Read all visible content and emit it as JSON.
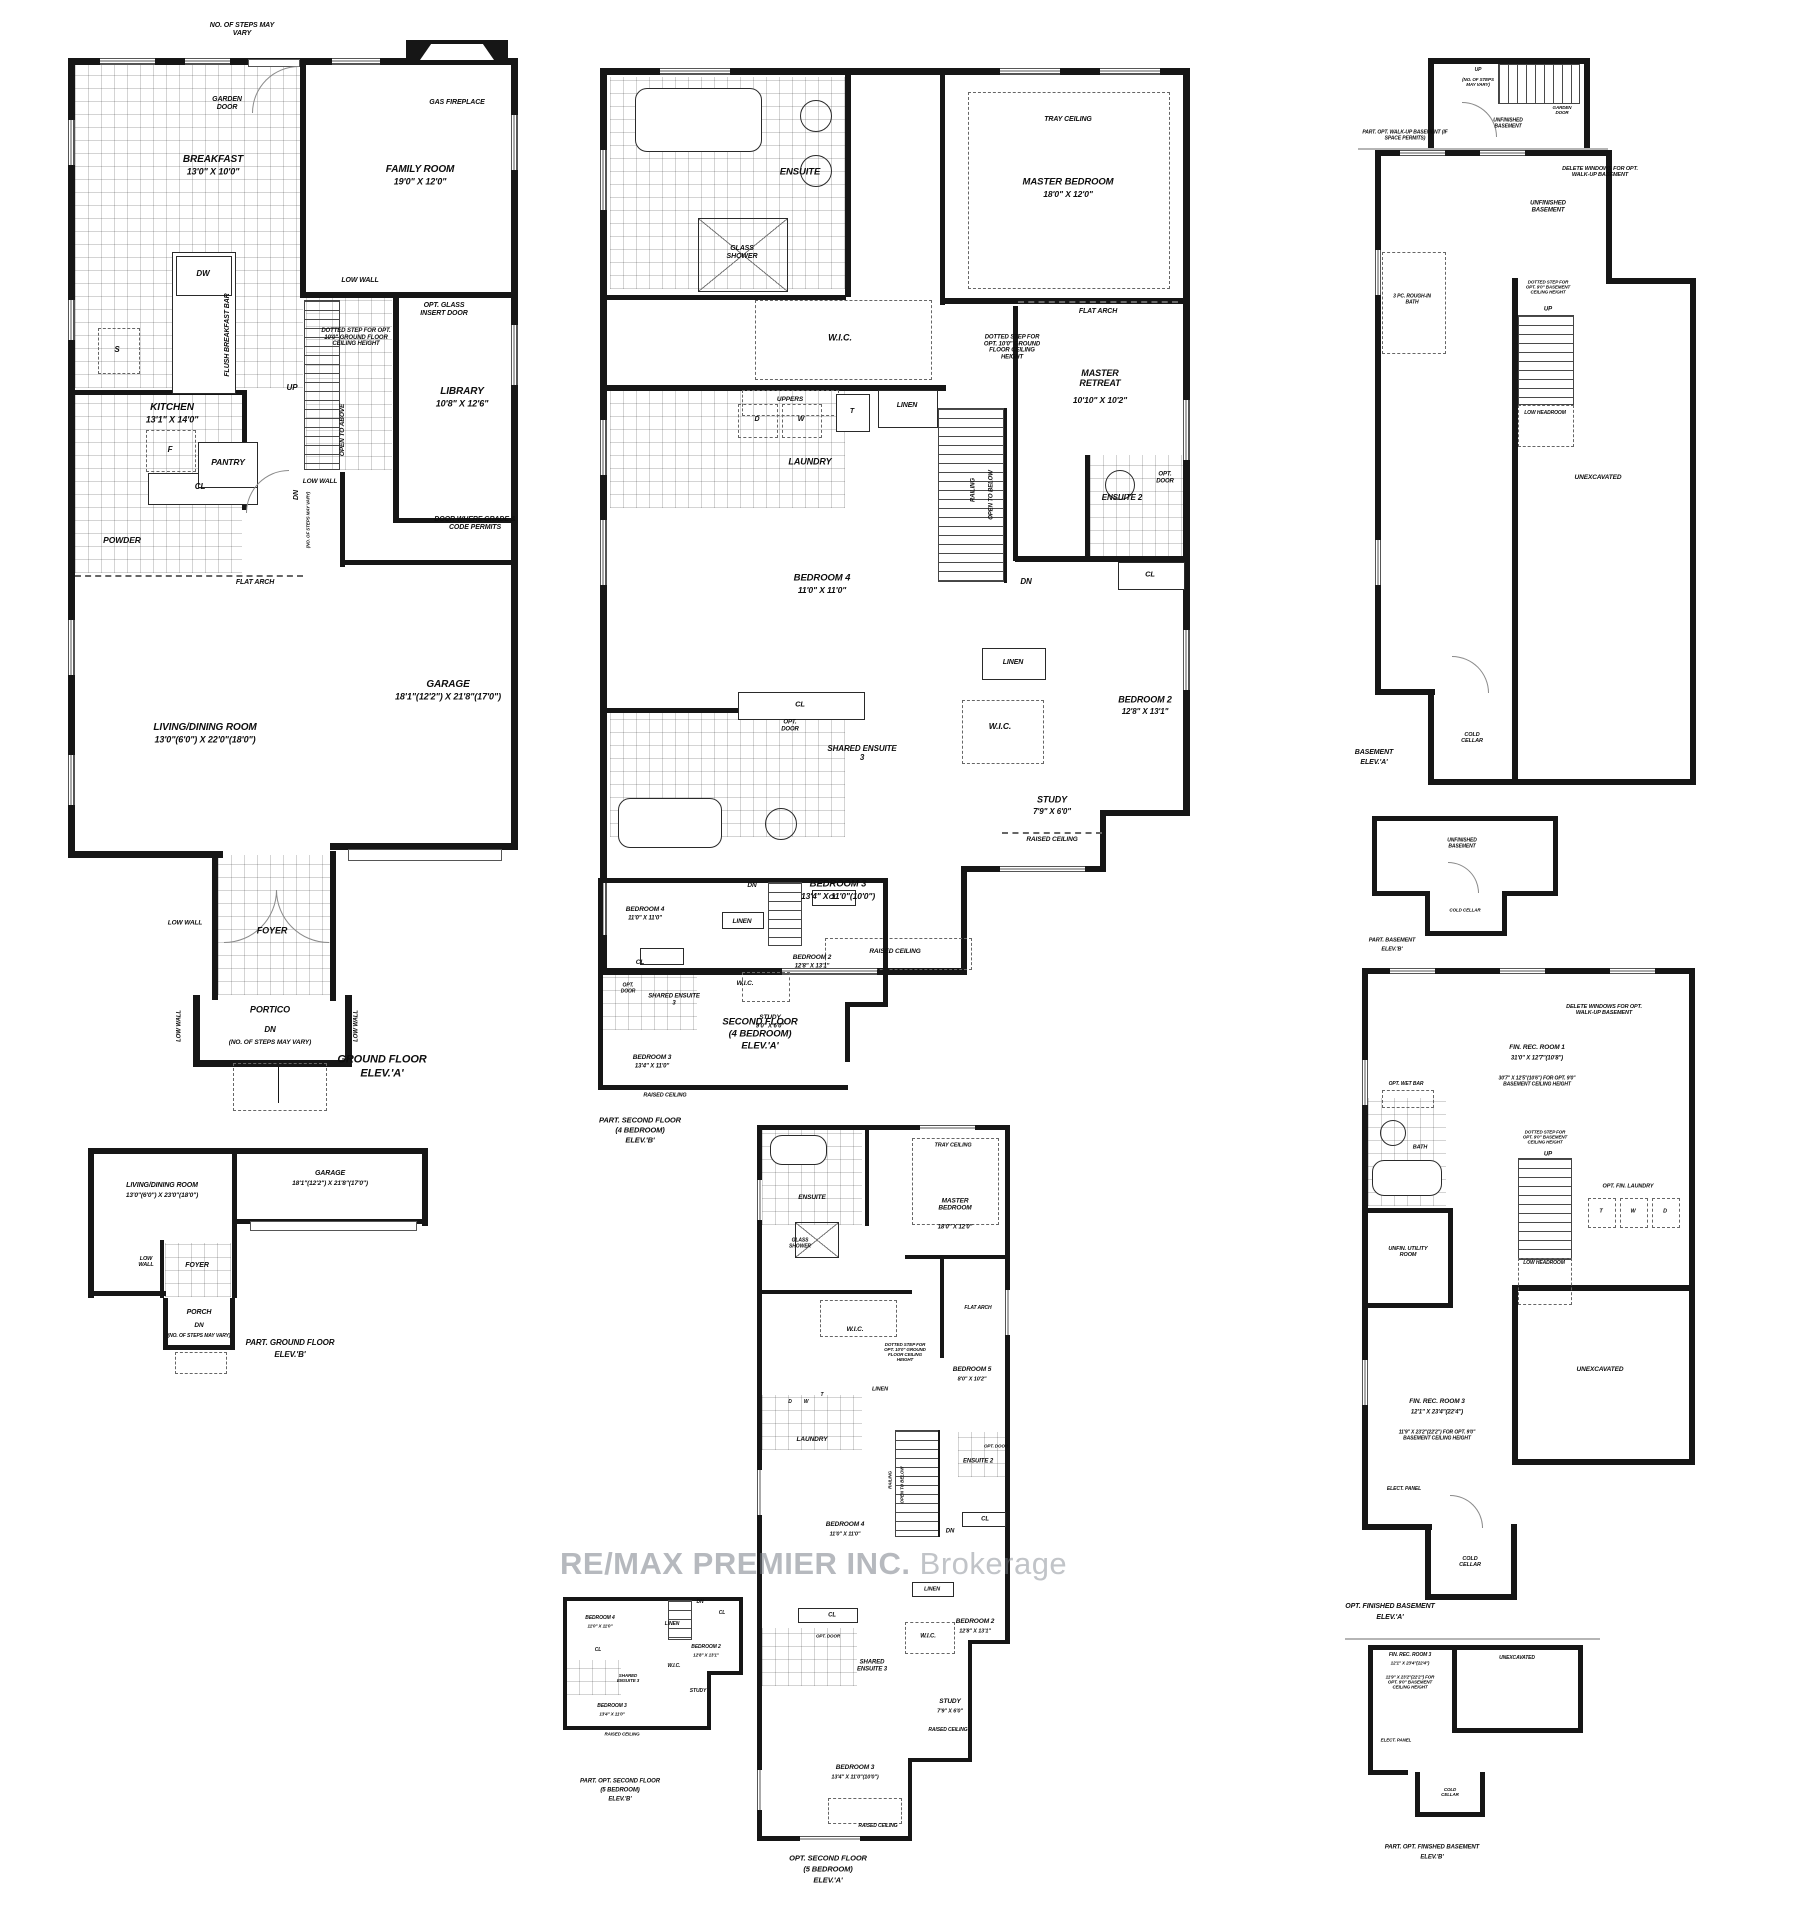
{
  "l": {
    "breakfast": "BREAKFAST",
    "breakfast_d": "13'0\" X 10'0\"",
    "family": "FAMILY ROOM",
    "family_d": "19'0\" X 12'0\"",
    "kitchen": "KITCHEN",
    "kitchen_d": "13'1\" X 14'0\"",
    "library": "LIBRARY",
    "library_d": "10'8\" X 12'6\"",
    "garage": "GARAGE",
    "garage_d": "18'1\"(12'2\") X 21'8\"(17'0\")",
    "living": "LIVING/DINING ROOM",
    "living_da": "13'0\"(6'0\") X 22'0\"(18'0\")",
    "living_db": "13'0\"(6'0\") X 23'0\"(18'0\")",
    "powder": "POWDER",
    "pantry": "PANTRY",
    "foyer": "FOYER",
    "portico": "PORTICO",
    "porch": "PORCH",
    "master": "MASTER BEDROOM",
    "master_d": "18'0\" X 12'0\"",
    "retreat": "MASTER RETREAT",
    "retreat_d": "10'10\" X 10'2\"",
    "bed2": "BEDROOM 2",
    "bed2_d": "12'8\" X 13'1\"",
    "bed3": "BEDROOM 3",
    "bed3_d": "13'4\" X 11'0\"(10'0\")",
    "bed3_db": "13'4\" X 11'0\"",
    "bed4": "BEDROOM 4",
    "bed4_d": "11'0\" X 11'0\"",
    "bed5": "BEDROOM 5",
    "bed5_d": "8'0\" X 10'2\"",
    "study": "STUDY",
    "study_d": "7'9\" X 6'0\"",
    "study_db": "9'0\" X 6'0\"",
    "ensuite": "ENSUITE",
    "ensuite2": "ENSUITE 2",
    "shared3": "SHARED ENSUITE 3",
    "fin1": "FIN. REC. ROOM 1",
    "fin1_d": "31'0\" X 12'7\"(10'8\")",
    "fin1_sub": "30'7\" X 12'5\"(10'6\") FOR OPT. 9'0\" BASEMENT CEILING HEIGHT",
    "fin3": "FIN. REC. ROOM 3",
    "fin3_d": "12'1\" X 23'4\"(22'4\")",
    "fin3_sub": "11'9\" X 23'2\"(22'2\") FOR OPT. 9'0\" BASEMENT CEILING HEIGHT",
    "utility": "UNFIN. UTILITY ROOM",
    "unex": "UNEXCAVATED",
    "unfin": "UNFINISHED BASEMENT",
    "cold": "COLD CELLAR",
    "laundry": "LAUNDRY",
    "wic": "W.I.C.",
    "cl": "CL",
    "linen": "LINEN",
    "up": "UP",
    "dn": "DN",
    "t": "T",
    "w": "W",
    "d": "D",
    "s": "S",
    "f": "F",
    "dw": "DW",
    "uppers": "UPPERS",
    "railing": "RAILING",
    "otb": "OPEN TO BELOW",
    "ota": "OPEN TO ABOVE",
    "low_wall": "LOW WALL",
    "low_headroom": "LOW HEADROOM",
    "raised": "RAISED CEILING",
    "tray": "TRAY CEILING",
    "flat_arch": "FLAT ARCH",
    "glass_shower": "GLASS SHOWER",
    "gas_fp": "GAS FIREPLACE",
    "garden": "GARDEN DOOR",
    "flush": "FLUSH BREAKFAST BAR",
    "opt_glass": "OPT. GLASS INSERT DOOR",
    "opt_door": "OPT. DOOR",
    "door_grade": "DOOR WHERE GRADE & CODE PERMITS",
    "dotted10": "DOTTED STEP FOR OPT. 10'0\" GROUND FLOOR CEILING HEIGHT",
    "dotted9": "DOTTED STEP FOR OPT. 9'0\" BASEMENT CEILING HEIGHT",
    "delete_win": "DELETE WINDOWS FOR OPT. WALK-UP BASEMENT",
    "rough": "3 PC. ROUGH-IN BATH",
    "wet_bar": "OPT. WET BAR",
    "bath": "BATH",
    "opt_fin_laundry": "OPT. FIN. LAUNDRY",
    "elect": "ELECT. PANEL",
    "steps_note": "(NO. OF STEPS MAY VARY)",
    "steps_vary": "NO. OF STEPS MAY VARY",
    "walkup_note": "PART. OPT. WALK-UP BASEMENT (IF SPACE PERMITS)"
  },
  "c": {
    "gfa1": "GROUND FLOOR",
    "gfa2": "ELEV.'A'",
    "gfb1": "PART. GROUND FLOOR",
    "gfb2": "ELEV.'B'",
    "sfa1": "SECOND FLOOR",
    "sfa2": "(4 BEDROOM)",
    "sfa3": "ELEV.'A'",
    "sfb1": "PART. SECOND FLOOR",
    "sfb2": "(4 BEDROOM)",
    "sfb3": "ELEV.'B'",
    "o5a1": "OPT. SECOND FLOOR",
    "o5a2": "(5 BEDROOM)",
    "o5a3": "ELEV.'A'",
    "o5b1": "PART. OPT. SECOND FLOOR",
    "o5b2": "(5 BEDROOM)",
    "o5b3": "ELEV.'B'",
    "ba1": "BASEMENT",
    "ba2": "ELEV.'A'",
    "bb1": "PART. BASEMENT",
    "bb2": "ELEV.'B'",
    "fba1": "OPT. FINISHED BASEMENT",
    "fba2": "ELEV.'A'",
    "fbb1": "PART. OPT. FINISHED BASEMENT",
    "fbb2": "ELEV.'B'"
  },
  "wm": {
    "brand": "RE/MAX PREMIER INC.",
    "suffix": " Brokerage"
  }
}
